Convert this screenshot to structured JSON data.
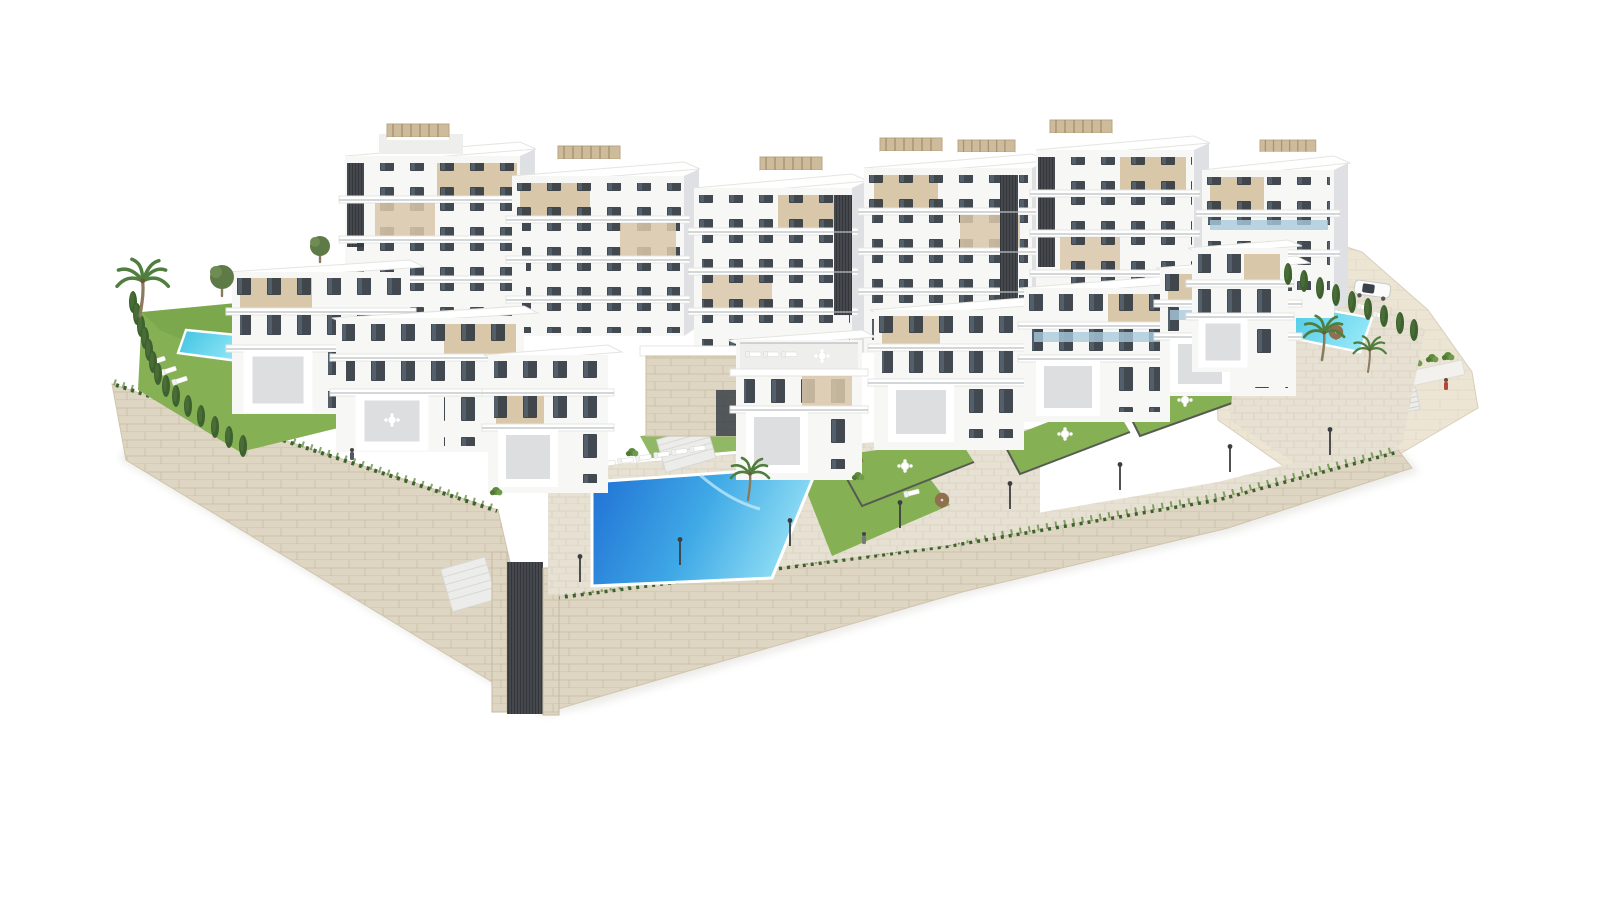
{
  "page": {
    "title": "Aerial 3D render — modern white residential complex on terraced hillside"
  },
  "scene": {
    "type": "architectural-3d-render",
    "description": "Aerial isometric rendering of a white modern apartment and villa complex built on stepped terraces with stone retaining walls, private lawns, three swimming pools, palm trees, cypress hedges, street lamps and a parked car",
    "background": "#ffffff",
    "camera": "aerial-oblique"
  },
  "palette": {
    "building_white": "#f7f7f5",
    "building_face2": "#eeeeec",
    "building_shade": "#dfe0e3",
    "slab_white": "#ffffff",
    "slab_edge": "#e4e4e0",
    "facade_beige": "#d9c7a9",
    "beige_dark": "#c6b292",
    "window_dark": "#343b43",
    "core_dark": "#45484c",
    "stone_base": "#ded6c2",
    "stone_line": "#c2b59c",
    "pave_base": "#e7e1d3",
    "pave_line": "#d5ccb8",
    "hill_base": "#ece5d4",
    "hill_line": "#dbd2bd",
    "lawn": "#85b054",
    "lawn_dark": "#6d9a42",
    "hedge": "#3e6130",
    "palm_green": "#4f7e3e",
    "pool_deep": "#1f6fd4",
    "pool_mid": "#3fa9e6",
    "pool_light": "#90def4",
    "pool_small1": "#3ec2e2",
    "pool_small2": "#8fe6f6",
    "umbrella": "#8f6f4e",
    "rail": "#b9bfc4",
    "fence": "#565b52",
    "lamp": "#3c3f41",
    "glass_blue": "#a9c9dc"
  },
  "inventory": {
    "back_apartment_blocks": 6,
    "front_villas": 8,
    "clubhouse": 1,
    "swimming_pools": 3,
    "private_gardens": 5,
    "palm_trees": 4,
    "cypress_trees": 23,
    "round_trees": 2,
    "sun_loungers": 21,
    "parasols": 5,
    "street_lamps": 8,
    "cars": 1,
    "stone_retaining_walls": 2,
    "entrance_gates": 1,
    "people": 3
  }
}
